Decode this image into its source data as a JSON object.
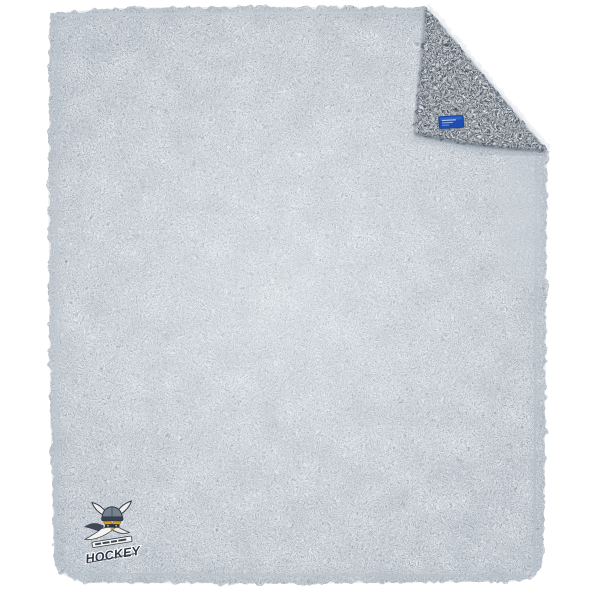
{
  "photo": {
    "background_color": "#ffffff",
    "subject": "Heather gray sherpa fleece blanket lying flat, top-right corner folded over showing the sherpa reverse side, a royal blue woven tag stitched at the fold edge, and an embroidered viking hockey team logo in the bottom-left corner"
  },
  "blanket": {
    "front_base_color": "#e7ebef",
    "front_speckle_color": "#8e99a6",
    "fold_base_color": "#9aa5b1",
    "fold_speckle_color": "#3f4a57",
    "seam_color": "#b9c2cb"
  },
  "tag": {
    "background_color": "#1e4eb0",
    "stitch_color": "#dce6f8"
  },
  "logo": {
    "wordmark": "HOCKEY",
    "wordmark_color": "#2e3644",
    "mascot": "viking-head-horned-helmet",
    "helmet_color": "#78828f",
    "helmet_dark_color": "#39414e",
    "horn_color": "#efeee9",
    "gold_accent_color": "#d79e23",
    "beard_color": "#f4f3ef"
  }
}
